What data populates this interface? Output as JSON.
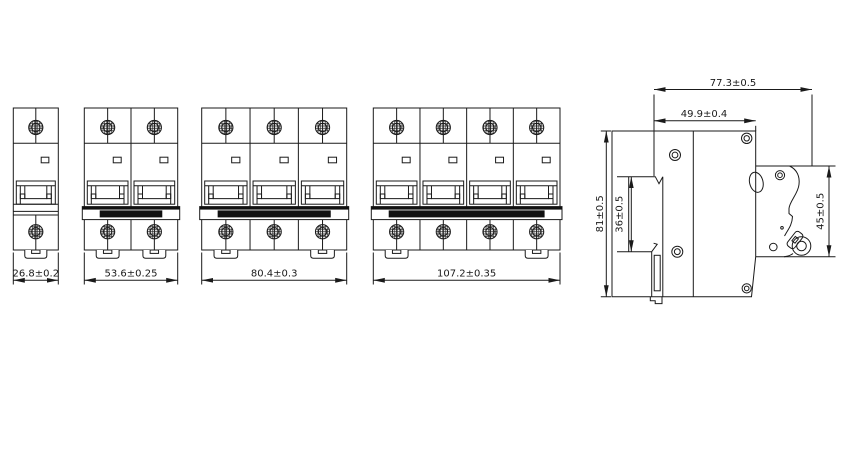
{
  "diagram": {
    "type": "technical-dimension-drawing",
    "subject": "miniature circuit breaker outline dimensions, front views of 1/2/3/4-pole units and side view",
    "colors": {
      "line": "#1a1a1a",
      "fill_black": "#111111",
      "background": "#ffffff"
    },
    "front_views": [
      {
        "name": "1-pole",
        "poles": 1,
        "width_label": "26.8±0.2",
        "x": 13.3,
        "width": 45.0
      },
      {
        "name": "2-pole",
        "poles": 2,
        "width_label": "53.6±0.25",
        "x": 84.3,
        "width": 93.4
      },
      {
        "name": "3-pole",
        "poles": 3,
        "width_label": "80.4±0.3",
        "x": 201.7,
        "width": 145.0
      },
      {
        "name": "4-pole",
        "poles": 4,
        "width_label": "107.2±0.35",
        "x": 373.3,
        "width": 186.7
      }
    ],
    "side_view": {
      "overall_depth": "77.3±0.5",
      "upper_depth": "49.9±0.4",
      "overall_height": "81±0.5",
      "rail_recess_height": "36±0.5",
      "front_housing_height": "45±0.5"
    }
  }
}
